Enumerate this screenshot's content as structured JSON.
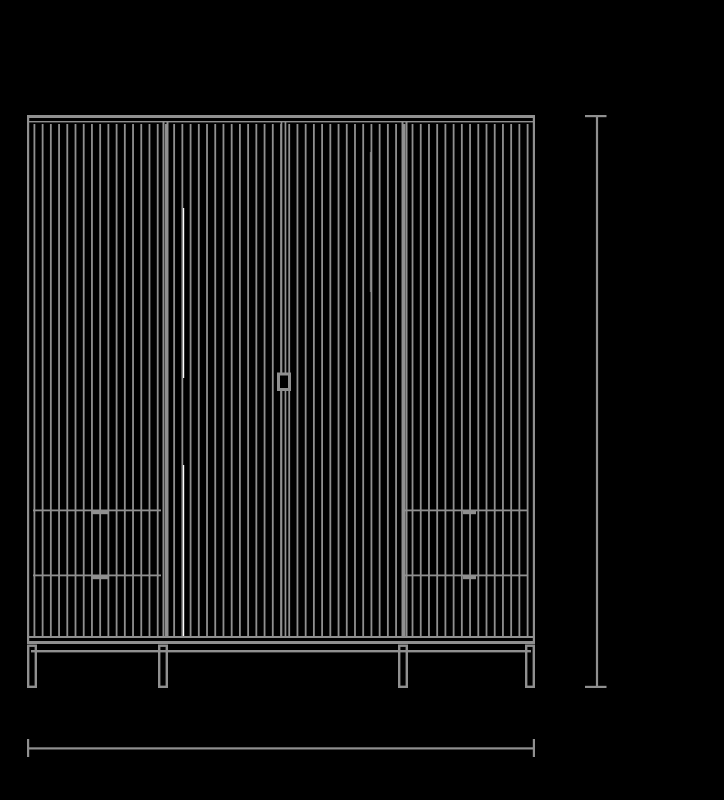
{
  "canvas": {
    "width": 724,
    "height": 800,
    "background": "#000000"
  },
  "colors": {
    "line": "#909090",
    "highlight": "#ffffff",
    "background": "#000000"
  },
  "drawing": {
    "frame": {
      "left": 27,
      "top": 115,
      "right": 535,
      "bottom": 644,
      "edge_thickness": 2.2
    },
    "top_bar": {
      "y": 115,
      "height": 3
    },
    "top_inner_line": {
      "y": 121,
      "height": 1.4
    },
    "slats": {
      "x_start": 33.5,
      "pitch": 8.22,
      "count": 61,
      "y_top": 124,
      "y_bottom": 636,
      "width": 1.8
    },
    "divider_y": {
      "top": 122,
      "bottom": 637
    },
    "dividers": [
      {
        "x": 162.5,
        "w": 2
      },
      {
        "x": 166.5,
        "w": 2
      },
      {
        "x": 280.6,
        "w": 1.7
      },
      {
        "x": 284.6,
        "w": 1.7
      },
      {
        "x": 401.5,
        "w": 2
      },
      {
        "x": 405.5,
        "w": 2
      }
    ],
    "door_handle": {
      "x": 277,
      "y": 372.5,
      "width": 14,
      "height": 18.5,
      "stroke": 3
    },
    "highlight_lines": [
      {
        "x": 183,
        "w": 1.2,
        "y1": 208,
        "y2": 378,
        "opacity": 1
      },
      {
        "x": 183,
        "w": 1.2,
        "y1": 465,
        "y2": 637,
        "opacity": 1
      },
      {
        "x": 369.8,
        "w": 1,
        "y1": 152,
        "y2": 292,
        "opacity": 0.35
      }
    ],
    "drawer_rows": [
      {
        "y": 509.5,
        "height": 1.8
      },
      {
        "y": 574.5,
        "height": 1.8
      }
    ],
    "drawer_spans": [
      {
        "x1": 33,
        "x2": 161,
        "handle_x": 92,
        "handle_w": 16
      },
      {
        "x1": 405,
        "x2": 528,
        "handle_x": 463,
        "handle_w": 13
      }
    ],
    "drawer_handle_height": 3.2,
    "bottom_lines": [
      {
        "y": 636,
        "height": 2
      },
      {
        "y": 641,
        "height": 3
      }
    ],
    "stretcher": {
      "y": 650,
      "height": 2.4,
      "x1": 31,
      "x2": 531
    },
    "legs": {
      "xs": [
        27,
        158,
        398,
        525
      ],
      "width": 10,
      "y_top": 644.5,
      "y_bottom": 688,
      "stroke": 2.4
    }
  },
  "dimension_lines": {
    "height": {
      "x": 595.9,
      "line_w": 2.2,
      "y1": 115,
      "y2": 688,
      "cap_x1": 585,
      "cap_w": 21.5,
      "cap_h": 2.2
    },
    "width": {
      "y": 747.3,
      "line_h": 2.2,
      "x1": 27,
      "x2": 535,
      "cap_y": 739,
      "cap_len": 18,
      "cap_w": 2.2
    }
  }
}
